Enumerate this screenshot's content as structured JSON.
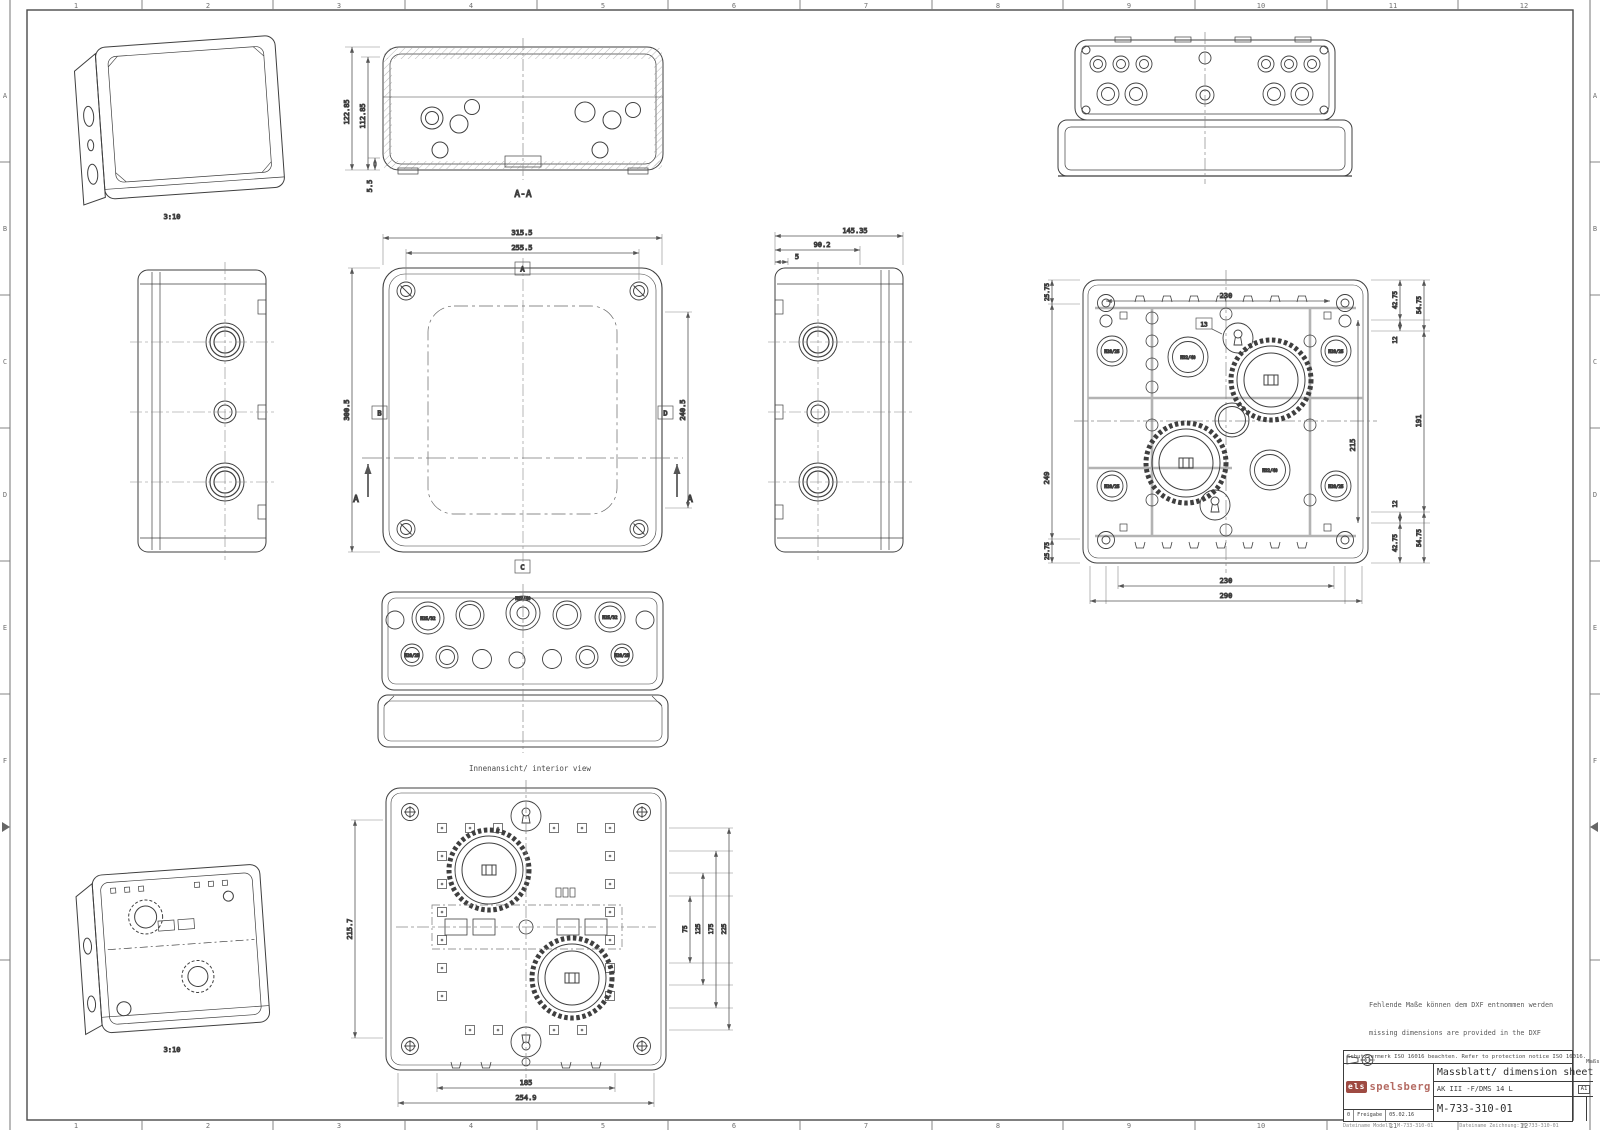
{
  "frame": {
    "columns": [
      "1",
      "2",
      "3",
      "4",
      "5",
      "6",
      "7",
      "8",
      "9",
      "10",
      "11",
      "12"
    ],
    "rows": [
      "A",
      "B",
      "C",
      "D",
      "E",
      "F"
    ]
  },
  "notes": {
    "de": "Fehlende Maße können dem DXF entnommen werden",
    "en": "missing dimensions are provided in the DXF"
  },
  "title_block": {
    "protection_note": "Schutzvermerk ISO 16016 beachten. Refer to protection notice ISO 16016.",
    "scale_caption": "Maßstab",
    "scale_value": "1:2",
    "doc_title": "Massblatt/ dimension sheet",
    "product": "AK III -F/DMS 14 L",
    "drawing_number": "M-733-310-01",
    "format": "A1",
    "brand_blocks": "els",
    "brand_name": "spelsberg",
    "rev_no": "0",
    "rev_desc": "Freigabe",
    "rev_date": "05.02.16",
    "file_model": "Dateiname Modell: M-733-310-01",
    "file_drawing": "Dateiname Zeichnung: M-733-310-01"
  },
  "views": {
    "iso_closed": {
      "scale": "3:10"
    },
    "iso_open": {
      "scale": "3:10"
    },
    "section": {
      "label": "A-A",
      "d1": "122.85",
      "d2": "112.85",
      "d3": "5.5"
    },
    "front": {
      "w1": "315.5",
      "w2": "255.5",
      "h1": "300.5",
      "h2": "240.5",
      "ref_top": "A",
      "ref_left": "B",
      "ref_right": "D",
      "ref_bottom": "C",
      "cut": "A"
    },
    "side": {
      "d1": "145.35",
      "d2": "90.2",
      "d3": "5"
    },
    "rear": {
      "top": "230",
      "lt": "25.75",
      "lm": "249",
      "lb": "25.75",
      "rt1": "42.75",
      "rg": "12",
      "rt2": "54.75",
      "mid": "191",
      "rb1": "42.75",
      "rgb": "12",
      "rb2": "54.75",
      "inner": "215",
      "b1": "230",
      "b2": "290",
      "flag": "13"
    },
    "interior": {
      "caption": "Innenansicht/ interior view",
      "left": "215.7",
      "r1": "75",
      "r2": "125",
      "r3": "175",
      "r4": "225",
      "b1": "185",
      "b2": "254.9"
    },
    "glands": {
      "g1": "M20/25",
      "g2": "M25/32",
      "g3": "M32/40"
    }
  }
}
